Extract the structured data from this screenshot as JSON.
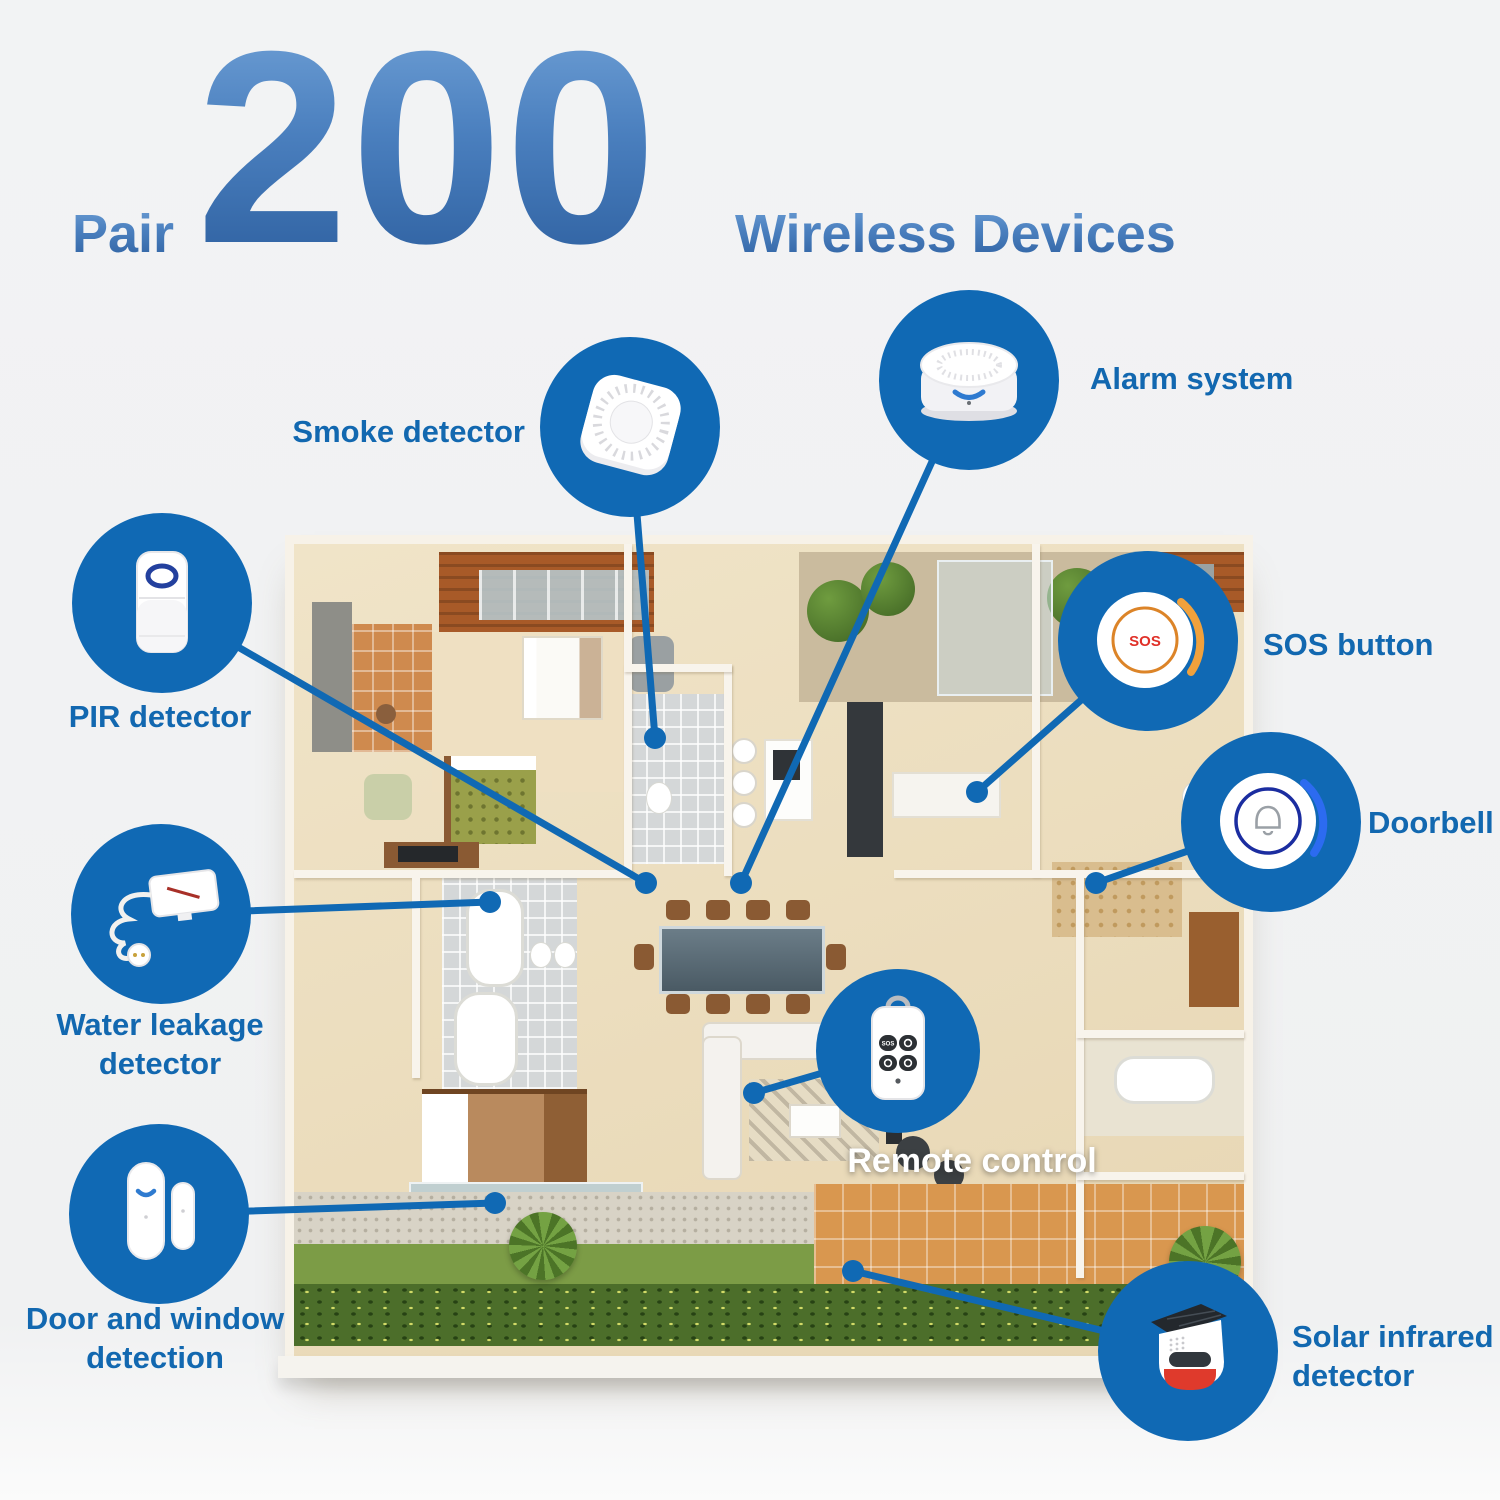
{
  "title": {
    "pair": "Pair",
    "number": "200",
    "suffix": "Wireless Devices"
  },
  "devices": [
    {
      "id": "smoke-detector",
      "lines": [
        "Smoke detector"
      ]
    },
    {
      "id": "alarm-system",
      "lines": [
        "Alarm system"
      ]
    },
    {
      "id": "pir-detector",
      "lines": [
        "PIR detector"
      ]
    },
    {
      "id": "sos-button",
      "lines": [
        "SOS button"
      ],
      "button_text": "SOS"
    },
    {
      "id": "doorbell",
      "lines": [
        "Doorbell"
      ]
    },
    {
      "id": "water-leakage-detector",
      "lines": [
        "Water leakage",
        "detector"
      ]
    },
    {
      "id": "remote-control",
      "lines": [
        "Remote control"
      ],
      "button_text": "SOS"
    },
    {
      "id": "door-window-detection",
      "lines": [
        "Door and window",
        "detection"
      ]
    },
    {
      "id": "solar-infrared-detector",
      "lines": [
        "Solar infrared",
        "detector"
      ]
    }
  ],
  "colors": {
    "accent_blue": "#1069b4",
    "label_blue": "#1268b0",
    "title_gradient_top": "#6fa0d6",
    "title_gradient_bottom": "#2d5f9f",
    "sos_text_red": "#e03028",
    "sos_ring_orange": "#dc8428",
    "doorbell_ring_navy": "#1b2da0",
    "siren_red": "#df3a2c",
    "background_gray": "#f1f2f3"
  }
}
